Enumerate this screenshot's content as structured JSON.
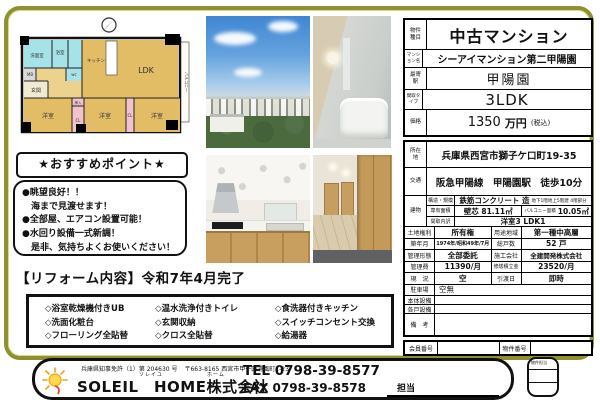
{
  "colors": {
    "frame_olive": "#8f9130",
    "room_tan": "#e3bc66",
    "wet_cyan": "#a5e3e8",
    "closet_pink": "#f2c3ca"
  },
  "floor_plan": {
    "labels": {
      "ldk": "LDK",
      "kitchen": "キッチン",
      "washroom": "洗面室",
      "bath": "浴室",
      "wc": "wc",
      "mb": "MB",
      "entrance": "玄関",
      "room1": "洋室",
      "room2": "洋室",
      "room3": "洋室",
      "cl1": "CL",
      "cl2": "CL",
      "oshiire": "押入",
      "balcony": "バルコニー"
    }
  },
  "points": {
    "header": "★おすすめポイント★",
    "items": [
      "●眺望良好！！",
      "　海まで見渡せます！",
      "●全部屋、エアコン設置可能！",
      "●水回り設備一式新調！",
      "　是非、気持ちよくお使いください！"
    ]
  },
  "reform": {
    "heading": "【リフォーム内容】令和7年4月完了",
    "columns": [
      [
        "◇浴室乾燥機付きUB",
        "◇洗面化粧台",
        "◇フローリング全貼替"
      ],
      [
        "◇温水洗浄付きトイレ",
        "◇玄関収納",
        "◇クロス全貼替"
      ],
      [
        "◇食洗器付きキッチン",
        "◇スイッチコンセント交換",
        "◇給湯器"
      ]
    ]
  },
  "property": {
    "type_label": "物件種目",
    "type": "中古マンション",
    "name_label": "マンション名",
    "name": "シーアイマンション第二甲陽園",
    "station_label": "最寄駅",
    "station": "甲陽園",
    "layout_label": "間取タイプ",
    "layout": "3LDK",
    "price_label": "価格",
    "price_value": "1350",
    "price_unit": "万円",
    "price_tax": "(税込)",
    "address_label": "所在地",
    "address": "兵庫県西宮市獅子ケ口町19-35",
    "access_label": "交通",
    "access": "阪急甲陽線　甲陽園駅　徒歩10分",
    "building_label": "建物",
    "structure_label": "構造・規模",
    "structure": "鉄筋コンクリート 造",
    "structure_note": "地下1階地上5階建 4階部分",
    "area_label": "専有面積",
    "area": "壁芯 81.11㎡",
    "balcony_area_label": "バルコニー面積",
    "balcony_area": "10.05㎡",
    "layout_detail_label": "間取内訳",
    "layout_detail": "洋室3 LDK1",
    "land_label": "土地権利",
    "land": "所有権",
    "zoning_label": "用途地域",
    "zoning": "第一種中高層",
    "built_label": "築年月",
    "built": "1974年/昭和49年/7月",
    "units_label": "総戸数",
    "units": "52 戸",
    "management_label": "管理形態",
    "management": "全部委託",
    "builder_label": "施工会社",
    "builder": "全建開発株式会社",
    "fee_label": "管理費",
    "fee": "11390/月",
    "reserve_label": "修繕積立金",
    "reserve": "23520/月",
    "status_label": "現　況",
    "status": "空",
    "handover_label": "引渡日",
    "handover": "即時",
    "parking_label": "駐車場",
    "parking": "空無",
    "main_equipment_label": "本体設備",
    "main_equipment": "",
    "unit_equipment_label": "各戸設備",
    "unit_equipment": "",
    "remarks_label": "備　考",
    "remarks": "",
    "member_no_label": "会員番号",
    "member_no": "",
    "property_no_label": "物件番号",
    "property_no": ""
  },
  "footer": {
    "license": "兵庫県知事免許（1）第 204630 号",
    "office_address": "〒663-8165 西宮市甲子園浦風町1-23",
    "company_furigana_1": "ソレイユ",
    "company_furigana_2": "ホーム",
    "company": "SOLEIL　HOME株式会社",
    "tel": "TEL 0798-39-8577",
    "fax": "FAX 0798-39-8578",
    "staff_label": "担当",
    "property_staff_label": "物件担当"
  }
}
